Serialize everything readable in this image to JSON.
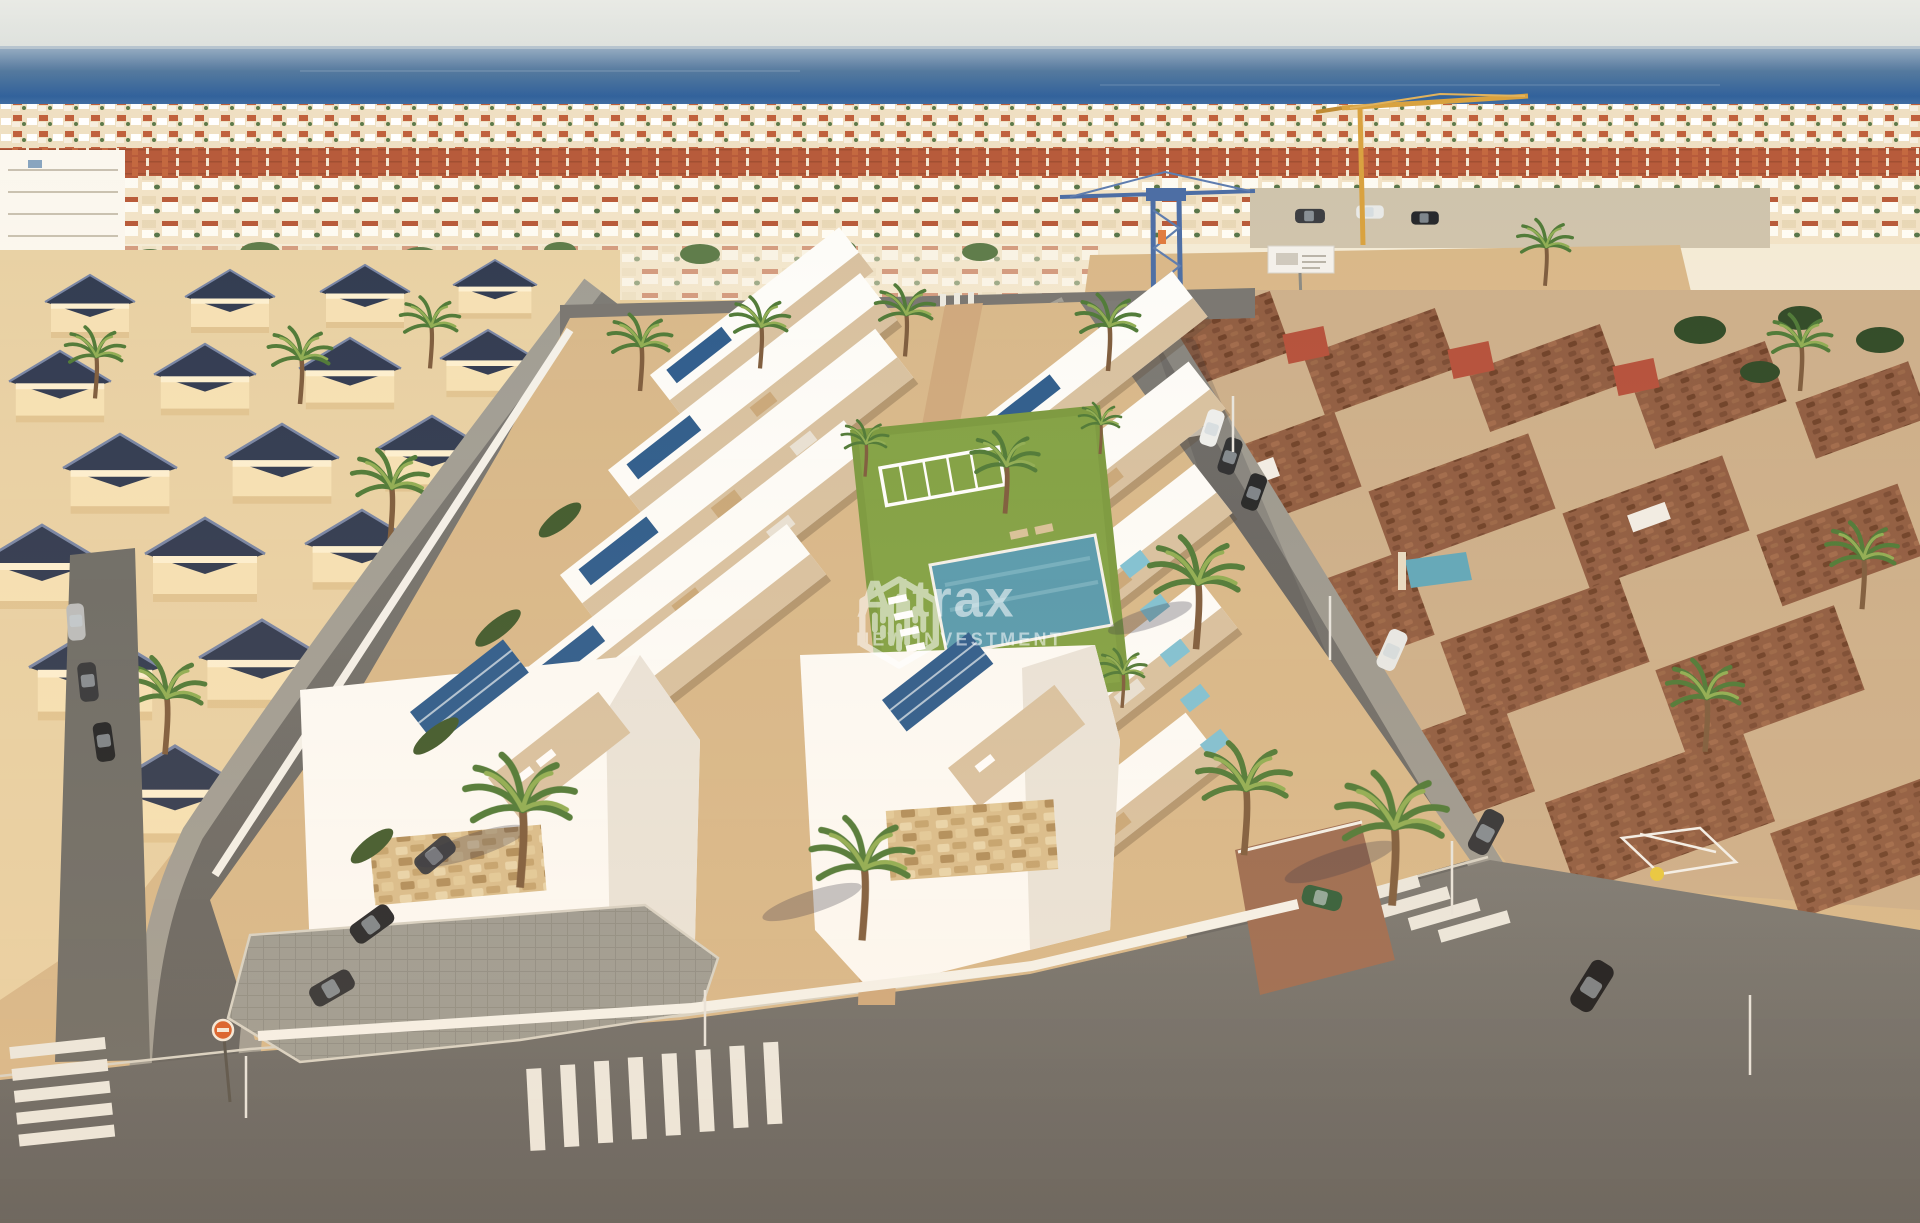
{
  "watermark": {
    "brand": "Altrax",
    "tagline": "NEW INVESTMENT",
    "icon": "hexagon-bars-logo-icon",
    "text_color": "#ffffff",
    "opacity": 0.55
  },
  "scene": {
    "description": "Sunset aerial render: new white villa development with rooftop solar panels and communal pool between existing Spanish villa districts, Mediterranean sea on the horizon, streets with crosswalks and palm trees, construction cranes in the distance",
    "colors": {
      "sky": "#e6e8e3",
      "sea_deep": "#31619c",
      "sea_light": "#9bb0c4",
      "town_cream": "#f1e0c2",
      "town_roof_red": "#b85a39",
      "left_villa_wall": "#f6e2b6",
      "left_villa_roof_navy": "#2f3a52",
      "development_white": "#fdfdfb",
      "terrace_tan": "#d8c2a2",
      "solar_panel_blue": "#2c5c8e",
      "pool_teal": "#569bb0",
      "lawn_green": "#7a9a40",
      "terracotta_roof": "#8f5c42",
      "road_gray": "#6b6b68",
      "sidewalk_gray": "#9c9c95",
      "crosswalk_white": "#eceae2",
      "sand": "#d9b98a",
      "palm_green": "#4e7a38",
      "crane_blue": "#4a6da6",
      "crane_yellow": "#d9a23f",
      "sign_orange": "#d95f2b"
    }
  }
}
